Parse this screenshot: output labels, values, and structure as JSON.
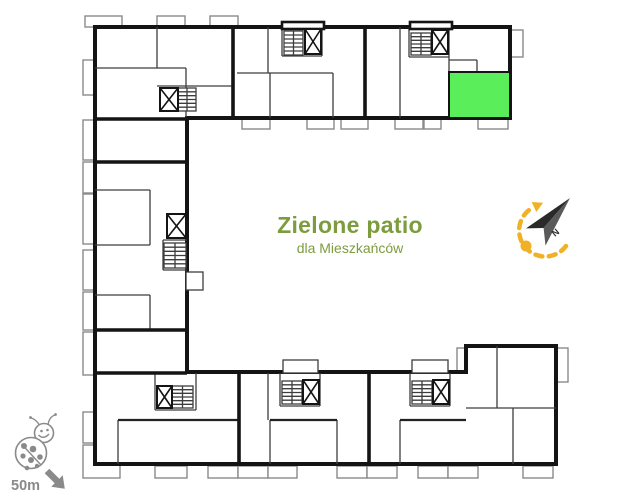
{
  "labels": {
    "patio_title": "Zielone patio",
    "patio_subtitle": "dla Mieszkańców",
    "scale_distance": "50m",
    "north": "N"
  },
  "colors": {
    "background": "#ffffff",
    "wall": "#141414",
    "wall_thin": "#3d3d3d",
    "wall_mid": "#222222",
    "balcony": "#8a8a8a",
    "highlight_unit": "#5bee5b",
    "patio_text": "#7d9c3e",
    "compass_yellow": "#f0b224",
    "needle_dark": "#2a2a2a",
    "needle_light": "#5a5a5a",
    "scale_gray": "#8a8a8a"
  },
  "plan": {
    "outline": "M95,27 L510,27 L510,118 L187,118 L187,372 L466,372 L466,346 L556,346 L556,464 L95,464 Z",
    "balconies": [
      [
        85,
        16,
        37,
        11
      ],
      [
        157,
        16,
        28,
        11
      ],
      [
        210,
        16,
        28,
        11
      ],
      [
        510,
        30,
        13,
        27
      ],
      [
        242,
        118,
        28,
        11
      ],
      [
        307,
        118,
        27,
        11
      ],
      [
        341,
        118,
        27,
        11
      ],
      [
        395,
        118,
        28,
        11
      ],
      [
        424,
        118,
        17,
        11
      ],
      [
        478,
        118,
        30,
        11
      ],
      [
        83,
        60,
        12,
        35
      ],
      [
        83,
        120,
        12,
        40
      ],
      [
        83,
        162,
        12,
        31
      ],
      [
        83,
        194,
        12,
        50
      ],
      [
        83,
        250,
        12,
        40
      ],
      [
        83,
        292,
        12,
        38
      ],
      [
        83,
        332,
        12,
        43
      ],
      [
        83,
        412,
        12,
        31
      ],
      [
        83,
        445,
        37,
        33
      ],
      [
        155,
        466,
        32,
        12
      ],
      [
        208,
        466,
        30,
        12
      ],
      [
        238,
        466,
        30,
        12
      ],
      [
        268,
        466,
        29,
        12
      ],
      [
        337,
        466,
        30,
        12
      ],
      [
        367,
        466,
        30,
        12
      ],
      [
        418,
        466,
        30,
        12
      ],
      [
        448,
        466,
        30,
        12
      ],
      [
        523,
        466,
        30,
        12
      ],
      [
        457,
        348,
        12,
        24
      ],
      [
        556,
        348,
        12,
        34
      ]
    ],
    "thick_walls": [
      [
        233,
        27,
        233,
        118
      ],
      [
        365,
        27,
        365,
        118
      ],
      [
        95,
        119,
        187,
        119
      ],
      [
        95,
        162,
        187,
        162
      ],
      [
        95,
        330,
        187,
        330
      ],
      [
        95,
        373,
        187,
        373
      ],
      [
        239,
        373,
        239,
        464
      ],
      [
        369,
        373,
        369,
        464
      ]
    ],
    "mid_walls": [
      [
        118,
        420,
        239,
        420
      ],
      [
        270,
        420,
        337,
        420
      ],
      [
        400,
        420,
        466,
        420
      ]
    ],
    "thin_walls": [
      [
        157,
        27,
        157,
        68
      ],
      [
        95,
        68,
        186,
        68
      ],
      [
        186,
        68,
        186,
        118
      ],
      [
        157,
        86,
        233,
        86
      ],
      [
        268,
        27,
        268,
        73
      ],
      [
        237,
        73,
        333,
        73
      ],
      [
        270,
        73,
        270,
        118
      ],
      [
        333,
        73,
        333,
        118
      ],
      [
        282,
        27,
        282,
        56
      ],
      [
        322,
        27,
        322,
        56
      ],
      [
        282,
        56,
        322,
        56
      ],
      [
        400,
        27,
        400,
        118
      ],
      [
        409,
        27,
        409,
        57
      ],
      [
        449,
        27,
        449,
        72
      ],
      [
        409,
        57,
        449,
        57
      ],
      [
        449,
        60,
        477,
        60
      ],
      [
        477,
        60,
        477,
        72
      ],
      [
        95,
        190,
        150,
        190
      ],
      [
        150,
        190,
        150,
        245
      ],
      [
        95,
        245,
        150,
        245
      ],
      [
        95,
        295,
        150,
        295
      ],
      [
        150,
        295,
        150,
        330
      ],
      [
        163,
        240,
        187,
        240
      ],
      [
        163,
        240,
        163,
        270
      ],
      [
        163,
        270,
        187,
        270
      ],
      [
        118,
        420,
        118,
        464
      ],
      [
        155,
        373,
        155,
        410
      ],
      [
        196,
        373,
        196,
        410
      ],
      [
        155,
        410,
        196,
        410
      ],
      [
        268,
        373,
        268,
        420
      ],
      [
        270,
        420,
        270,
        464
      ],
      [
        337,
        420,
        337,
        464
      ],
      [
        280,
        373,
        280,
        406
      ],
      [
        320,
        373,
        320,
        406
      ],
      [
        280,
        406,
        320,
        406
      ],
      [
        410,
        373,
        410,
        406
      ],
      [
        450,
        373,
        450,
        406
      ],
      [
        410,
        406,
        450,
        406
      ],
      [
        400,
        420,
        400,
        464
      ],
      [
        497,
        346,
        497,
        408
      ],
      [
        466,
        408,
        556,
        408
      ],
      [
        513,
        408,
        513,
        464
      ]
    ],
    "bumps": [
      [
        282,
        22,
        42,
        7
      ],
      [
        410,
        22,
        42,
        7
      ]
    ],
    "entries": [
      [
        283,
        360,
        35,
        13
      ],
      [
        412,
        360,
        36,
        13
      ],
      [
        186,
        272,
        17,
        18
      ]
    ],
    "elevators": [
      [
        160,
        88,
        18,
        23
      ],
      [
        305,
        29,
        16,
        25
      ],
      [
        432,
        30,
        16,
        24
      ],
      [
        167,
        214,
        19,
        24
      ],
      [
        157,
        386,
        15,
        22
      ],
      [
        303,
        380,
        16,
        24
      ],
      [
        433,
        380,
        16,
        24
      ]
    ],
    "stairs": [
      [
        178,
        88,
        18,
        23
      ],
      [
        284,
        31,
        19,
        24
      ],
      [
        411,
        33,
        20,
        22
      ],
      [
        164,
        243,
        22,
        25
      ],
      [
        172,
        386,
        21,
        22
      ],
      [
        282,
        381,
        20,
        23
      ],
      [
        412,
        381,
        20,
        23
      ]
    ],
    "highlight_unit": [
      449,
      72,
      61,
      46
    ]
  }
}
